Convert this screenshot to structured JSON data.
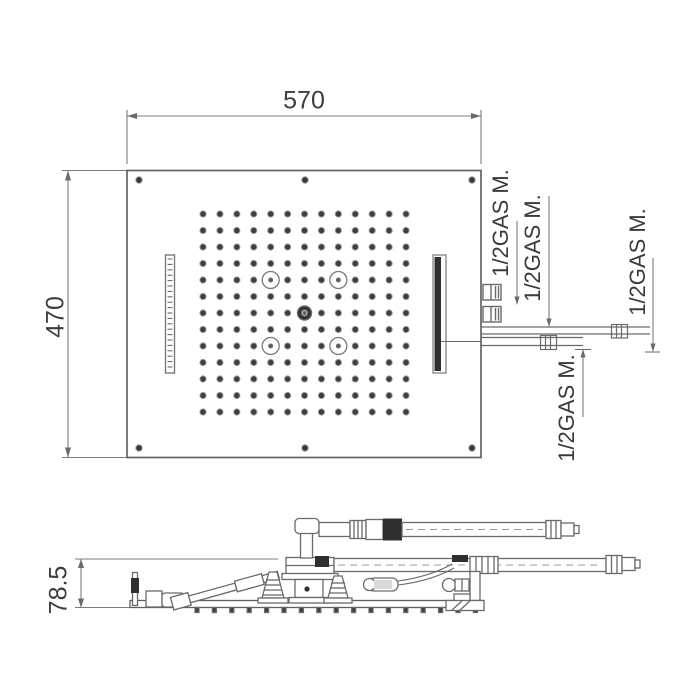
{
  "colors": {
    "line": "#6a6a6a",
    "thin": "#7d7d7d",
    "dark": "#2f2f2f",
    "text": "#3d3d3d",
    "background": "#ffffff"
  },
  "dimensions": {
    "width": "570",
    "height": "470",
    "side_height": "78.5"
  },
  "connection_labels": [
    "1/2GAS M.",
    "1/2GAS M.",
    "1/2GAS M.",
    "1/2GAS M."
  ],
  "plan": {
    "nozzle_grid": {
      "rows": 13,
      "cols": 13,
      "x0": 203,
      "y0": 214,
      "dx": 16.92,
      "dy": 16.5,
      "dot_r": 3.1,
      "led_cells": [
        [
          5,
          5
        ],
        [
          9,
          5
        ],
        [
          5,
          9
        ],
        [
          9,
          9
        ]
      ],
      "led_r": 8.5,
      "center_cell": [
        7,
        7
      ]
    },
    "left_slot_ticks": {
      "count": 21,
      "x1": 167.6,
      "x2": 172.4,
      "y0": 259,
      "dy": 5.4
    },
    "screw_positions": [
      [
        139,
        180
      ],
      [
        305,
        180
      ],
      [
        472,
        180
      ],
      [
        139,
        448
      ],
      [
        305,
        448
      ],
      [
        472,
        448
      ]
    ]
  },
  "side": {
    "spray_ticks": {
      "count": 17,
      "x0": 197,
      "dx": 17.4,
      "y": 607.5,
      "w": 4,
      "h": 5
    }
  }
}
